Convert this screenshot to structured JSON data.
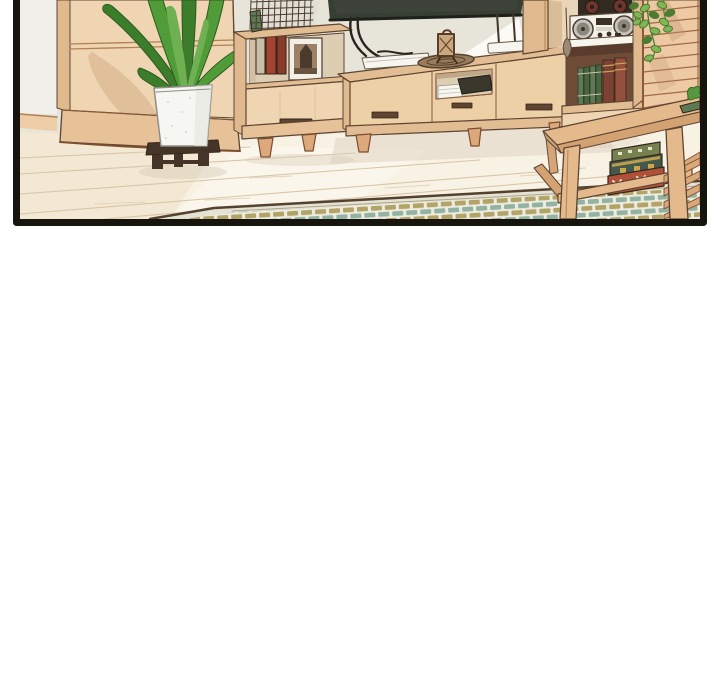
{
  "page": {
    "background": "#ffffff"
  },
  "panel": {
    "alt": "Webtoon panel: a cozy living-room corner with a tall wooden wardrobe, a leafy potted plant in a white planter on a dark wooden stand, a wall-mounted TV with cables above a long wooden media console, a cube bookshelf holding red books and a framed photo, a hutch bookcase with a boombox stereo, speakers and books, a hanging vine over wooden blinds, and a wooden coffee table with decorated books on its lower shelf, all standing on a pale plank floor with a green-and-olive checkered rug.",
    "border_color": "#17130d"
  },
  "scene": {
    "objects": [
      "living room comic panel",
      "tall wooden wardrobe",
      "potted plant on dark stand",
      "cube bookshelf with books and framed photo",
      "wire grid memo board",
      "wall-mounted TV",
      "wooden media console",
      "white device with cables",
      "wicker tray",
      "ornamental stand mirror",
      "wi-fi router",
      "bookcase hutch",
      "boombox stereo",
      "speaker box",
      "shelf books",
      "hanging vine",
      "hanging feather charm",
      "wooden blinds",
      "checkered rug",
      "coffee table",
      "stacked decorated books",
      "ladder chair",
      "plank wood floor",
      "baseboard",
      "left wall"
    ]
  },
  "colors": {
    "page": "#ffffff",
    "border": "#17130d",
    "ink": "#5e4531",
    "ink_dark": "#33251a",
    "wall": "#e7e4da",
    "wall_light": "#f1efe9",
    "wall_bright": "#fbfaf5",
    "baseboard": "#eccda6",
    "wood_face": "#f0d5b2",
    "wood_side": "#e0ba8e",
    "wood_trim": "#b08154",
    "console_top": "#e2bd93",
    "console_face": "#eed0a7",
    "wood_leg": "#dca87c",
    "plinth": "#e7c299",
    "floor": "#f8f2e5",
    "floor_warm": "#f1e5d0",
    "floor_bright": "#fcf8f0",
    "plank": "#d5c2a2",
    "shadow": "#d9cdba",
    "plant": "#4f9c38",
    "plant_dark": "#3c7d2b",
    "plant_light": "#6fb052",
    "plant_line": "#2c5a20",
    "pot": "#f6f6f2",
    "pot_line": "#8f8f86",
    "stand": "#443528",
    "tv": "#373e32",
    "tv_edge": "#1e211b",
    "mesh": "#4a3c30",
    "frame_white": "#f2efe6",
    "photo": "#9b8165",
    "photo_dark": "#4c3a2c",
    "book_tan": "#c9bfa8",
    "book_red": "#a34330",
    "book_red2": "#8a3a28",
    "niche": "#6e4c38",
    "book_green": "#5d7b52",
    "book_green2": "#49653f",
    "book_brown": "#7b4233",
    "book_brown2": "#93503c",
    "stereo": "#f3f1ea",
    "stereo_ring": "#c9c5bc",
    "stereo_inner": "#8b867b",
    "speaker_box": "#332a22",
    "speaker_cone": "#6e352c",
    "hutch_bg": "#e9d6ba",
    "hutch_shadow": "#d9bd97",
    "blind": "#edcaa4",
    "blind_line": "#a06b45",
    "blind_shade": "#c1946b",
    "vine": "#7fb757",
    "vine_dark": "#4c7c31",
    "rug_teal": "#92b3a1",
    "rug_olive": "#b1a466",
    "rug_bg": "#edebdf",
    "rug_band": "#e4e2d3",
    "rug_edge": "#54422f",
    "table_top": "#e4ba8d",
    "table_face": "#d3a273",
    "tbook_olive": "#76814f",
    "tbook_teal": "#44584c",
    "tbook_red": "#b05038",
    "tbook_gold": "#c9a84c",
    "tbook_cream": "#e8e0d2",
    "tray": "#9a7c5c",
    "tray_line": "#54402c",
    "white_obj": "#f6f5f0",
    "cable": "#2a241e",
    "handle": "#5f4430",
    "dark_obj": "#3a372c",
    "interior": "#ddcdb2"
  }
}
